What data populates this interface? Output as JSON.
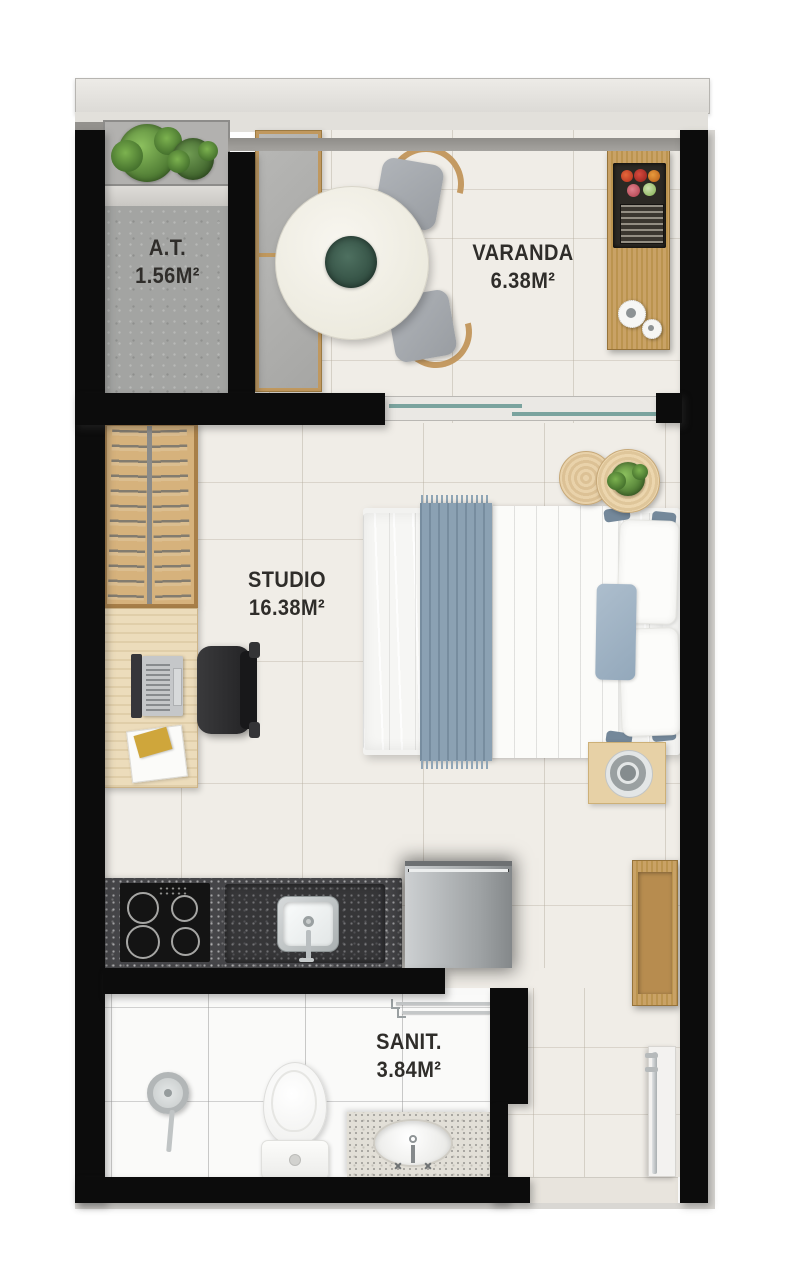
{
  "rooms": {
    "at": {
      "label": "A.T.",
      "area": "1.56M²"
    },
    "varanda": {
      "label": "VARANDA",
      "area": "6.38M²"
    },
    "studio": {
      "label": "STUDIO",
      "area": "16.38M²"
    },
    "sanit": {
      "label": "SANIT.",
      "area": "3.84M²"
    }
  },
  "colors": {
    "wall": "#0c0c0c",
    "floor": "#f0ede7",
    "concrete": "#a3a4a2",
    "wood": "#c9a266",
    "counter_granite": "#454548",
    "label_text": "#2f2d2a",
    "glass_door": "#7aa39e",
    "throw_blanket": "#8fa5b6"
  }
}
